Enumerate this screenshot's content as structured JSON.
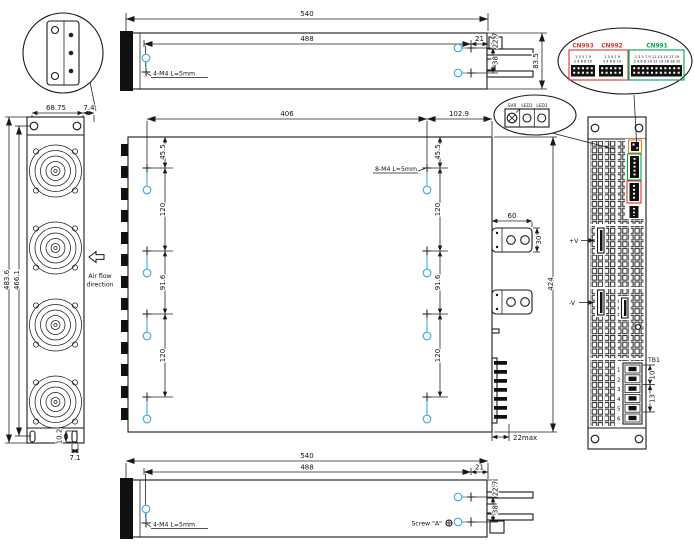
{
  "colors": {
    "marker_blue": "#3fa9dc",
    "cn_red": "#d03a2e",
    "cn_green": "#00a550",
    "cn_orange": "#f08019",
    "line": "#1a1a1a"
  },
  "top_view": {
    "dim_total": "540",
    "dim_holes": "488",
    "dim_right": "21",
    "dim_hole_top": "22.7",
    "dim_hole_pitch": "38",
    "dim_height": "83.5",
    "screw_label": "4-M4 L=5mm"
  },
  "front_view": {
    "dim_width": "68.75",
    "dim_offset": "7.4",
    "dim_height": "483.6",
    "dim_inner_height": "466.1",
    "dim_slot": "10.2",
    "dim_slot_offset": "7.1",
    "airflow_line1": "Air flow",
    "airflow_line2": "direction"
  },
  "side_view": {
    "dim_width": "406",
    "dim_rear": "102.9",
    "dim_top": "45.5",
    "dim_pitch_a": "120",
    "dim_pitch_b": "91.6",
    "screw_label": "8-M4 L=5mm",
    "dim_bus_width": "60",
    "dim_bus_height": "30",
    "dim_height": "424",
    "dim_terminal": "22max"
  },
  "rear_view": {
    "pos_label": "+V",
    "neg_label": "-V",
    "tb_label": "TB1",
    "pins": [
      "1",
      "2",
      "3",
      "4",
      "5",
      "6"
    ],
    "dim_a": "10",
    "dim_b": "13"
  },
  "connector_detail": {
    "cn_a": "CN993",
    "cn_b": "CN992",
    "cn_c": "CN991",
    "pins_odd_10": "1 3 5 7 9",
    "pins_even_10": "2 4 6 8 10",
    "pins_odd_20": "1 3 5 7 9 11 13 15 17 19",
    "pins_even_20": "2 4 6 8 10 12 14 16 18 20"
  },
  "adjust_detail": {
    "svr": "SVR",
    "led2": "LED2",
    "led1": "LED1"
  },
  "bottom_view": {
    "dim_total": "540",
    "dim_holes": "488",
    "dim_right": "21",
    "dim_hole_top": "22.7",
    "dim_hole_pitch": "38",
    "screw_label": "4-M4 L=5mm",
    "screw_a_label": "Screw \"A\""
  }
}
